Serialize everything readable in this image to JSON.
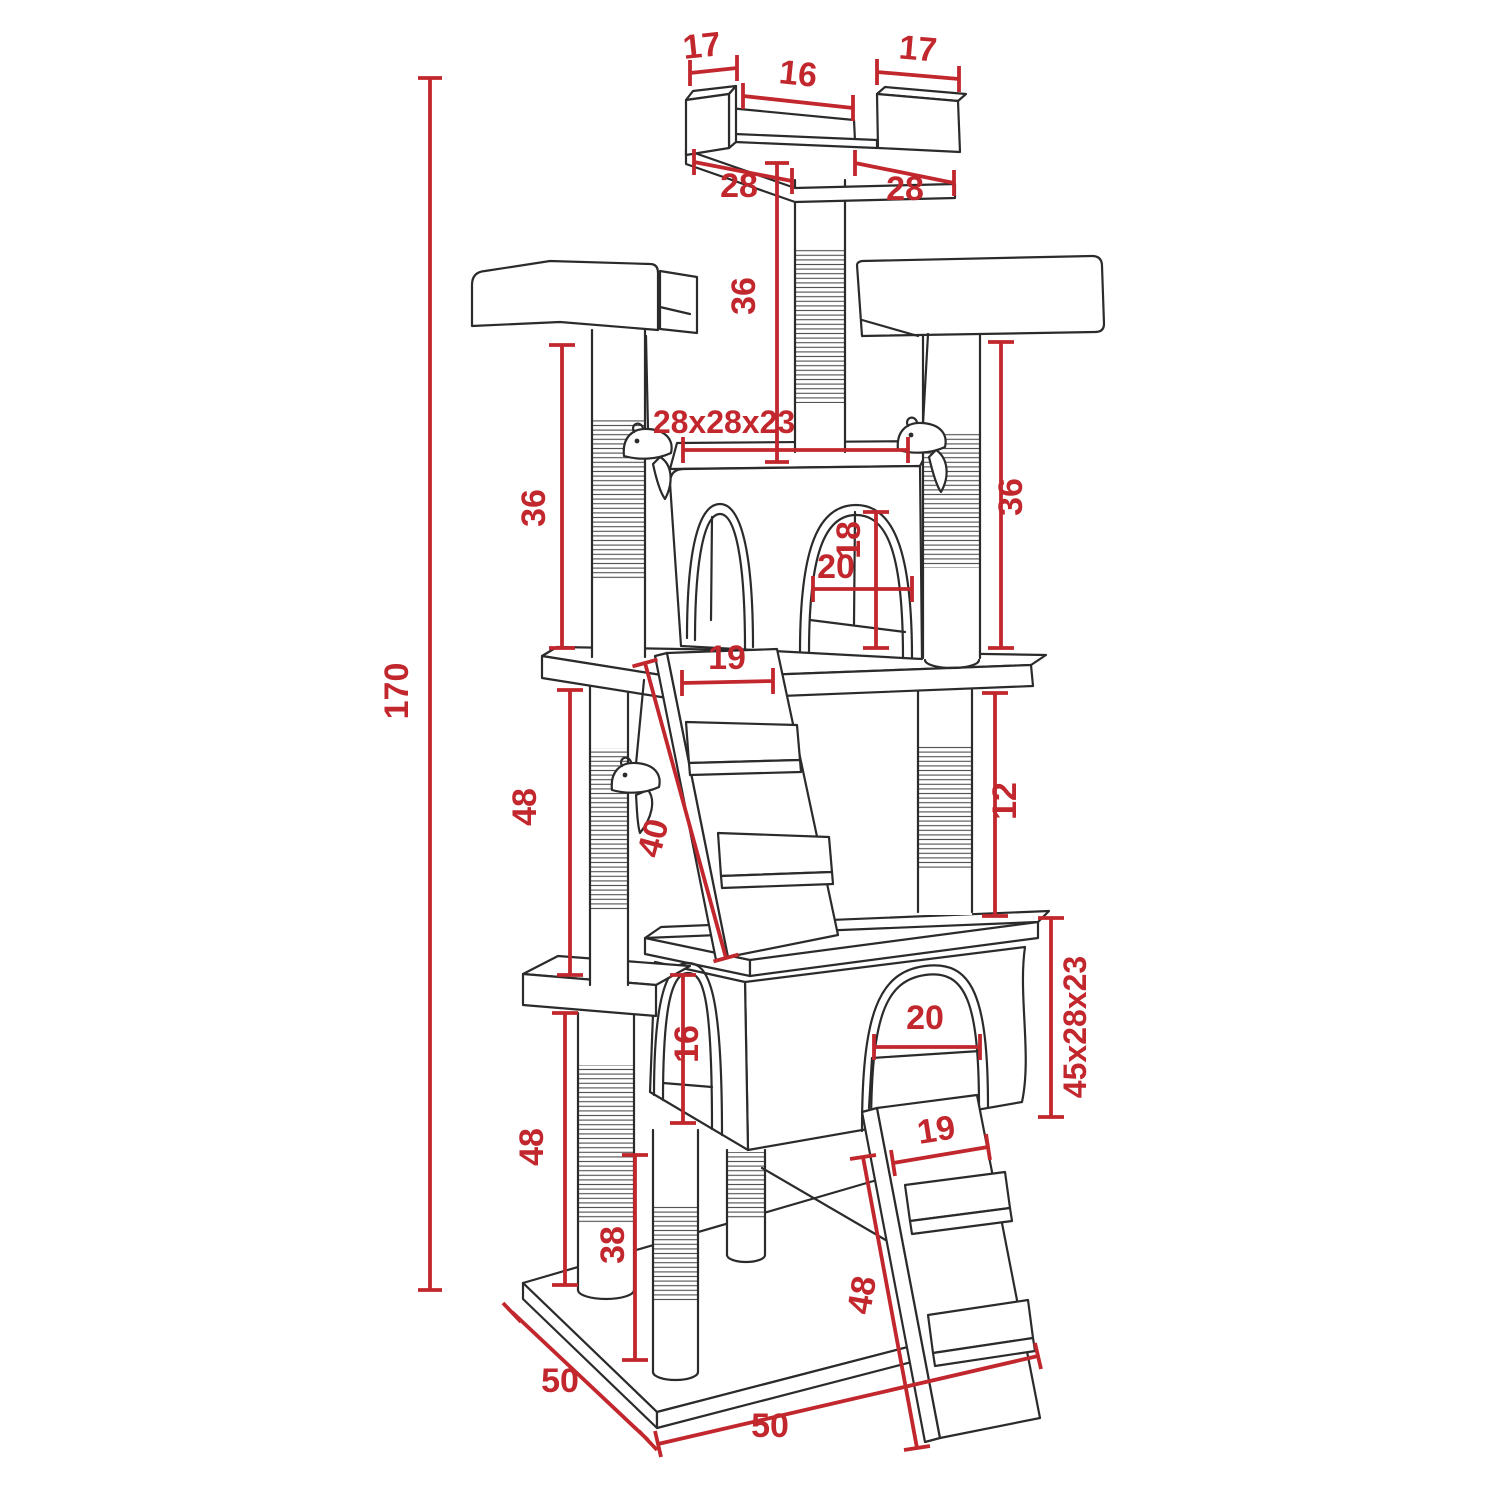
{
  "figure": {
    "type": "technical dimension diagram",
    "subject": "cat tree scratching-post tower line drawing"
  },
  "colors": {
    "background": "#ffffff",
    "outline": "#2b2b2b",
    "dimension_red": "#C1272D"
  },
  "dimensions": {
    "top_cap_left": "17",
    "top_gap": "16",
    "top_cap_right": "17",
    "top_base_left": "28",
    "top_base_right": "28",
    "top_pole_height": "36",
    "upper_condo_size": "28x28x23",
    "left_upper_post": "36",
    "right_upper_post": "36",
    "upper_arch_height": "18",
    "upper_arch_width": "20",
    "upper_ramp_width": "19",
    "upper_ramp_length": "40",
    "total_height": "170",
    "left_middle_post": "48",
    "right_middle_post": "12",
    "lower_arch_height": "16",
    "lower_arch_width": "20",
    "lower_condo_size": "45x28x23",
    "lower_ramp_width": "19",
    "left_lower_post": "48",
    "center_lower_post": "38",
    "lower_ramp_length": "48",
    "base_depth": "50",
    "base_width": "50"
  }
}
